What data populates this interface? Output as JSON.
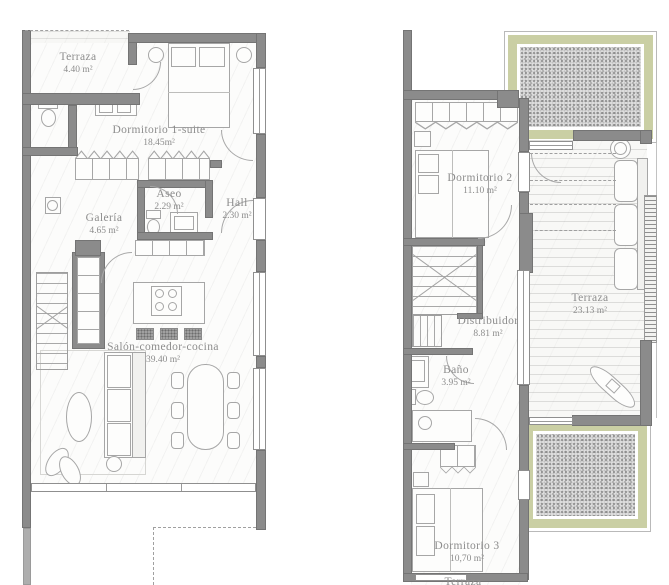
{
  "ground": {
    "rooms": [
      {
        "name": "Terraza",
        "area": "4.40 m²"
      },
      {
        "name": "Dormitorio 1-suite",
        "area": "18.45m²"
      },
      {
        "name": "Aseo",
        "area": "2.29 m²"
      },
      {
        "name": "Hall",
        "area": "2.30 m²"
      },
      {
        "name": "Galería",
        "area": "4.65 m²"
      },
      {
        "name": "Salón-comedor-cocina",
        "area": "39.40 m²"
      }
    ]
  },
  "upper": {
    "rooms": [
      {
        "name": "Dormitorio 2",
        "area": "11.10 m²"
      },
      {
        "name": "Terraza",
        "area": "23.13 m²"
      },
      {
        "name": "Distribuidor",
        "area": "8.81 m²"
      },
      {
        "name": "Baño",
        "area": "3.95 m²"
      },
      {
        "name": "Dormitorio 3",
        "area": "10,70 m²"
      },
      {
        "name": "Terraza",
        "area": ""
      }
    ]
  },
  "colors": {
    "wall": "#8b8b8b",
    "wall_light": "#aeaeae",
    "fixture_outline": "#a6a6a6",
    "label_text": "#8d8d8d",
    "pergola_green": "#cacfa4",
    "gravel_gray": "#dcdcdc",
    "floor": "#fcfcfb"
  }
}
